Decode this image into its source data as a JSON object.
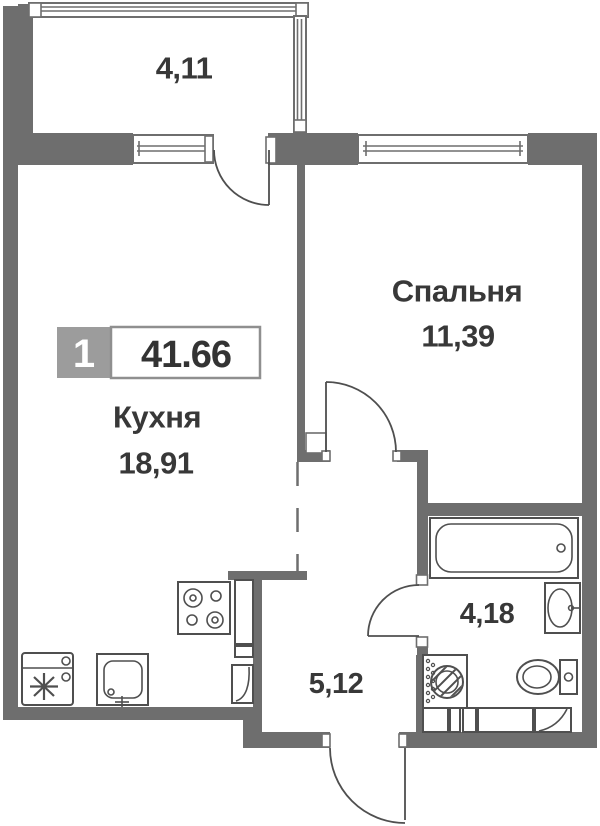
{
  "floorplan": {
    "badge": {
      "room_count": "1",
      "total_area": "41.66"
    },
    "rooms": {
      "balcony": {
        "area": "4,11"
      },
      "kitchen": {
        "name": "Кухня",
        "area": "18,91"
      },
      "bedroom": {
        "name": "Спальня",
        "area": "11,39"
      },
      "bathroom": {
        "area": "4,18"
      },
      "hallway": {
        "area": "5,12"
      }
    },
    "colors": {
      "wall": "#6e6e6e",
      "fixture_line": "#4f4f4f",
      "text": "#383838",
      "badge_gray": "#9c9c9c",
      "background": "#ffffff"
    }
  }
}
